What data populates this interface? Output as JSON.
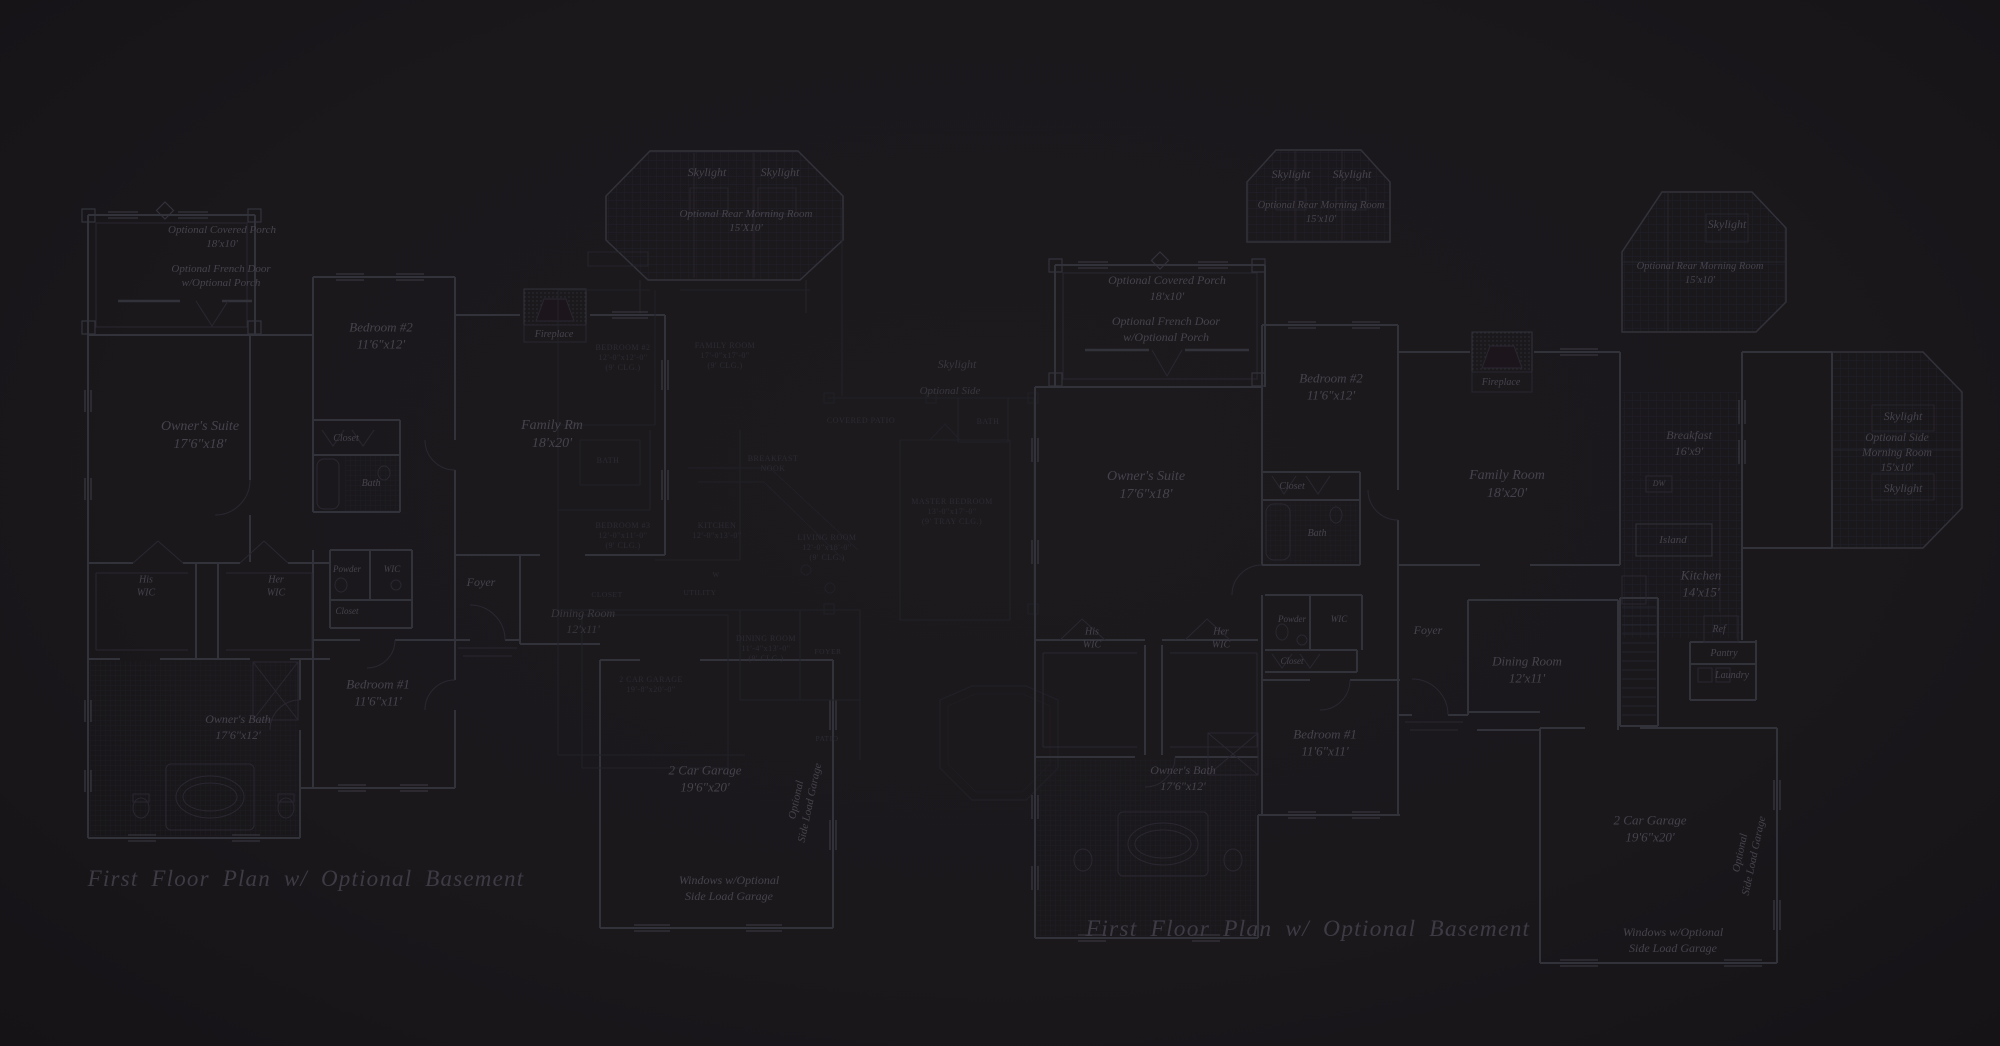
{
  "palette": {
    "background": "#1a181b",
    "wall_main": "#33313a",
    "wall_detail": "#2a2830",
    "wall_faint": "#232129",
    "grid_line": "#242230",
    "tile_line": "#221f28",
    "fireplace_dot": "#2f2d35",
    "window_tick": "#3c3a44",
    "text_main": "#46434d",
    "text_caps": "#2d2b33",
    "text_title": "#3e3b45"
  },
  "plan_left": {
    "title": "First Floor Plan  w/ Optional Basement",
    "labels": [
      {
        "name": "label-covered-porch",
        "lines": [
          "Optional Covered Porch",
          "18'x10'"
        ],
        "x": 222,
        "y": 240,
        "size": 11,
        "tier": "main"
      },
      {
        "name": "label-french-door",
        "lines": [
          "Optional French Door",
          "w/Optional Porch"
        ],
        "x": 221,
        "y": 279,
        "size": 11,
        "tier": "main"
      },
      {
        "name": "label-skylight-1",
        "lines": [
          "Skylight"
        ],
        "x": 707,
        "y": 176,
        "size": 12,
        "tier": "main"
      },
      {
        "name": "label-skylight-2",
        "lines": [
          "Skylight"
        ],
        "x": 780,
        "y": 176,
        "size": 12,
        "tier": "main"
      },
      {
        "name": "label-rear-morning-room",
        "lines": [
          "Optional Rear Morning Room",
          "15'X10'"
        ],
        "x": 746,
        "y": 224,
        "size": 11,
        "tier": "main"
      },
      {
        "name": "label-bedroom-2",
        "lines": [
          "Bedroom #2",
          "11'6\"x12'"
        ],
        "x": 381,
        "y": 340,
        "size": 13,
        "tier": "main"
      },
      {
        "name": "label-fireplace",
        "lines": [
          "Fireplace"
        ],
        "x": 554,
        "y": 337,
        "size": 10,
        "tier": "main"
      },
      {
        "name": "label-family-rm",
        "lines": [
          "Family Rm",
          "18'x20'"
        ],
        "x": 552,
        "y": 438,
        "size": 14,
        "tier": "main"
      },
      {
        "name": "label-owners-suite",
        "lines": [
          "Owner's Suite",
          "17'6\"x18'"
        ],
        "x": 200,
        "y": 439,
        "size": 14,
        "tier": "main"
      },
      {
        "name": "label-closet-1",
        "lines": [
          "Closet"
        ],
        "x": 346,
        "y": 441,
        "size": 10,
        "tier": "main"
      },
      {
        "name": "label-bath",
        "lines": [
          "Bath"
        ],
        "x": 371,
        "y": 486,
        "size": 10,
        "tier": "main"
      },
      {
        "name": "label-his-wic",
        "lines": [
          "His",
          "WIC"
        ],
        "x": 146,
        "y": 589,
        "size": 10,
        "tier": "main"
      },
      {
        "name": "label-her-wic",
        "lines": [
          "Her",
          "WIC"
        ],
        "x": 276,
        "y": 589,
        "size": 10,
        "tier": "main"
      },
      {
        "name": "label-powder",
        "lines": [
          "Powder"
        ],
        "x": 347,
        "y": 572,
        "size": 9,
        "tier": "main"
      },
      {
        "name": "label-wic",
        "lines": [
          "WIC"
        ],
        "x": 392,
        "y": 572,
        "size": 9,
        "tier": "main"
      },
      {
        "name": "label-closet-2",
        "lines": [
          "Closet"
        ],
        "x": 347,
        "y": 614,
        "size": 9,
        "tier": "main"
      },
      {
        "name": "label-foyer",
        "lines": [
          "Foyer"
        ],
        "x": 481,
        "y": 586,
        "size": 12,
        "tier": "main"
      },
      {
        "name": "label-dining",
        "lines": [
          "Dining Room",
          "12'x11'"
        ],
        "x": 583,
        "y": 625,
        "size": 12,
        "tier": "main",
        "op": 0.7
      },
      {
        "name": "label-bedroom-1",
        "lines": [
          "Bedroom #1",
          "11'6\"x11'"
        ],
        "x": 378,
        "y": 697,
        "size": 13,
        "tier": "main"
      },
      {
        "name": "label-owners-bath",
        "lines": [
          "Owner's Bath",
          "17'6\"x12'"
        ],
        "x": 238,
        "y": 731,
        "size": 12,
        "tier": "main"
      },
      {
        "name": "label-garage",
        "lines": [
          "2 Car Garage",
          "19'6\"x20'"
        ],
        "x": 705,
        "y": 783,
        "size": 13,
        "tier": "main"
      },
      {
        "name": "label-side-load-garage",
        "lines": [
          "Optional",
          "Side Load Garage"
        ],
        "x": 806,
        "y": 802,
        "size": 11,
        "tier": "main",
        "rot": -78
      },
      {
        "name": "label-windows-side-load",
        "lines": [
          "Windows w/Optional",
          "Side Load Garage"
        ],
        "x": 729,
        "y": 892,
        "size": 12,
        "tier": "main"
      }
    ]
  },
  "plan_middle": {
    "labels": [
      {
        "name": "label-bedroom2-caps",
        "lines": [
          "BEDROOM #2",
          "12'-0\"x12'-0\"",
          "(9' CLG.)"
        ],
        "x": 623,
        "y": 360,
        "size": 8,
        "tier": "caps"
      },
      {
        "name": "label-family-room-caps",
        "lines": [
          "FAMILY ROOM",
          "17'-0\"x17'-0\"",
          "(9' CLG.)"
        ],
        "x": 725,
        "y": 358,
        "size": 8,
        "tier": "caps"
      },
      {
        "name": "label-bath-caps-1",
        "lines": [
          "BATH"
        ],
        "x": 608,
        "y": 463,
        "size": 8,
        "tier": "caps"
      },
      {
        "name": "label-breakfast-nook-caps",
        "lines": [
          "BREAKFAST",
          "NOOK"
        ],
        "x": 773,
        "y": 466,
        "size": 8,
        "tier": "caps"
      },
      {
        "name": "label-bedroom3-caps",
        "lines": [
          "BEDROOM #3",
          "12'-0\"x11'-0\"",
          "(9' CLG.)"
        ],
        "x": 623,
        "y": 538,
        "size": 8,
        "tier": "caps"
      },
      {
        "name": "label-kitchen-caps",
        "lines": [
          "KITCHEN",
          "12'-0\"x13'-0\""
        ],
        "x": 717,
        "y": 533,
        "size": 8,
        "tier": "caps"
      },
      {
        "name": "label-living-room-caps",
        "lines": [
          "LIVING ROOM",
          "12'-0\"x18'-0\"",
          "(9' CLG.)"
        ],
        "x": 827,
        "y": 550,
        "size": 8,
        "tier": "caps"
      },
      {
        "name": "label-closet-caps",
        "lines": [
          "CLOSET"
        ],
        "x": 607,
        "y": 597,
        "size": 7.5,
        "tier": "caps"
      },
      {
        "name": "label-utility-caps",
        "lines": [
          "UTILITY"
        ],
        "x": 700,
        "y": 595,
        "size": 7.5,
        "tier": "caps"
      },
      {
        "name": "label-washer-caps",
        "lines": [
          "W"
        ],
        "x": 716,
        "y": 577,
        "size": 7,
        "tier": "caps"
      },
      {
        "name": "label-garage-caps",
        "lines": [
          "2 CAR GARAGE",
          "19'-8\"x20'-0\""
        ],
        "x": 651,
        "y": 687,
        "size": 8,
        "tier": "caps"
      },
      {
        "name": "label-dining-room-caps",
        "lines": [
          "DINING ROOM",
          "11'-4\"x13'-0\"",
          "(9' CLG.)"
        ],
        "x": 766,
        "y": 651,
        "size": 8,
        "tier": "caps"
      },
      {
        "name": "label-foyer-caps",
        "lines": [
          "FOYER"
        ],
        "x": 828,
        "y": 654,
        "size": 7.5,
        "tier": "caps"
      },
      {
        "name": "label-patio-caps",
        "lines": [
          "PATIO"
        ],
        "x": 827,
        "y": 741,
        "size": 7.5,
        "tier": "caps"
      },
      {
        "name": "label-covered-patio-caps",
        "lines": [
          "COVERED PATIO"
        ],
        "x": 861,
        "y": 423,
        "size": 8,
        "tier": "caps"
      },
      {
        "name": "label-bath-caps-2",
        "lines": [
          "BATH"
        ],
        "x": 988,
        "y": 424,
        "size": 8,
        "tier": "caps"
      },
      {
        "name": "label-master-bedroom-caps",
        "lines": [
          "MASTER BEDROOM",
          "13'-0\"x17'-0\"",
          "(9' TRAY CLG.)"
        ],
        "x": 952,
        "y": 514,
        "size": 8,
        "tier": "caps"
      },
      {
        "name": "label-skylight-mid",
        "lines": [
          "Skylight"
        ],
        "x": 957,
        "y": 368,
        "size": 12,
        "tier": "main",
        "op": 0.7
      },
      {
        "name": "label-optional-side-mid",
        "lines": [
          "Optional Side"
        ],
        "x": 950,
        "y": 394,
        "size": 11,
        "tier": "main",
        "op": 0.7
      }
    ]
  },
  "plan_right": {
    "title": "First Floor Plan  w/ Optional Basement",
    "labels": [
      {
        "name": "label-covered-porch",
        "lines": [
          "Optional Covered Porch",
          "18'x10'"
        ],
        "x": 1167,
        "y": 292,
        "size": 12,
        "tier": "main"
      },
      {
        "name": "label-french-door",
        "lines": [
          "Optional French Door",
          "w/Optional Porch"
        ],
        "x": 1166,
        "y": 333,
        "size": 12,
        "tier": "main"
      },
      {
        "name": "label-skylight-1",
        "lines": [
          "Skylight"
        ],
        "x": 1291,
        "y": 178,
        "size": 12,
        "tier": "main"
      },
      {
        "name": "label-skylight-2",
        "lines": [
          "Skylight"
        ],
        "x": 1352,
        "y": 178,
        "size": 12,
        "tier": "main"
      },
      {
        "name": "label-rear-morning-room-1",
        "lines": [
          "Optional Rear Morning Room",
          "15'x10'"
        ],
        "x": 1321,
        "y": 215,
        "size": 10.5,
        "tier": "main"
      },
      {
        "name": "label-skylight-3",
        "lines": [
          "Skylight"
        ],
        "x": 1727,
        "y": 228,
        "size": 12,
        "tier": "main"
      },
      {
        "name": "label-rear-morning-room-2",
        "lines": [
          "Optional Rear Morning Room",
          "15'x10'"
        ],
        "x": 1700,
        "y": 276,
        "size": 10.5,
        "tier": "main"
      },
      {
        "name": "label-owners-suite",
        "lines": [
          "Owner's Suite",
          "17'6\"x18'"
        ],
        "x": 1146,
        "y": 489,
        "size": 14,
        "tier": "main"
      },
      {
        "name": "label-bedroom-2",
        "lines": [
          "Bedroom #2",
          "11'6\"x12'"
        ],
        "x": 1331,
        "y": 391,
        "size": 13,
        "tier": "main"
      },
      {
        "name": "label-fireplace",
        "lines": [
          "Fireplace"
        ],
        "x": 1501,
        "y": 385,
        "size": 10,
        "tier": "main"
      },
      {
        "name": "label-family-room",
        "lines": [
          "Family Room",
          "18'x20'"
        ],
        "x": 1507,
        "y": 488,
        "size": 14,
        "tier": "main"
      },
      {
        "name": "label-breakfast",
        "lines": [
          "Breakfast",
          "16'x9'"
        ],
        "x": 1689,
        "y": 447,
        "size": 12,
        "tier": "main"
      },
      {
        "name": "label-dw",
        "lines": [
          "DW"
        ],
        "x": 1659,
        "y": 486,
        "size": 8,
        "tier": "main"
      },
      {
        "name": "label-island",
        "lines": [
          "Island"
        ],
        "x": 1673,
        "y": 543,
        "size": 11,
        "tier": "main"
      },
      {
        "name": "label-kitchen",
        "lines": [
          "Kitchen",
          "14'x15'"
        ],
        "x": 1701,
        "y": 588,
        "size": 13,
        "tier": "main"
      },
      {
        "name": "label-ref",
        "lines": [
          "Ref"
        ],
        "x": 1719,
        "y": 632,
        "size": 10,
        "tier": "main"
      },
      {
        "name": "label-pantry",
        "lines": [
          "Pantry"
        ],
        "x": 1724,
        "y": 656,
        "size": 10,
        "tier": "main"
      },
      {
        "name": "label-laundry",
        "lines": [
          "Laundry"
        ],
        "x": 1732,
        "y": 678,
        "size": 10,
        "tier": "main"
      },
      {
        "name": "label-closet-1",
        "lines": [
          "Closet"
        ],
        "x": 1292,
        "y": 489,
        "size": 10,
        "tier": "main"
      },
      {
        "name": "label-bath",
        "lines": [
          "Bath"
        ],
        "x": 1317,
        "y": 536,
        "size": 10,
        "tier": "main"
      },
      {
        "name": "label-his-wic",
        "lines": [
          "His",
          "WIC"
        ],
        "x": 1092,
        "y": 641,
        "size": 10,
        "tier": "main"
      },
      {
        "name": "label-her-wic",
        "lines": [
          "Her",
          "WIC"
        ],
        "x": 1221,
        "y": 641,
        "size": 10,
        "tier": "main"
      },
      {
        "name": "label-powder",
        "lines": [
          "Powder"
        ],
        "x": 1292,
        "y": 622,
        "size": 9,
        "tier": "main"
      },
      {
        "name": "label-wic",
        "lines": [
          "WIC"
        ],
        "x": 1339,
        "y": 622,
        "size": 9,
        "tier": "main"
      },
      {
        "name": "label-closet-2",
        "lines": [
          "Closet"
        ],
        "x": 1292,
        "y": 664,
        "size": 9,
        "tier": "main"
      },
      {
        "name": "label-foyer",
        "lines": [
          "Foyer"
        ],
        "x": 1428,
        "y": 634,
        "size": 12,
        "tier": "main"
      },
      {
        "name": "label-dining-room",
        "lines": [
          "Dining Room",
          "12'x11'"
        ],
        "x": 1527,
        "y": 674,
        "size": 13,
        "tier": "main"
      },
      {
        "name": "label-bedroom-1",
        "lines": [
          "Bedroom #1",
          "11'6\"x11'"
        ],
        "x": 1325,
        "y": 747,
        "size": 13,
        "tier": "main"
      },
      {
        "name": "label-owners-bath",
        "lines": [
          "Owner's Bath",
          "17'6\"x12'"
        ],
        "x": 1183,
        "y": 782,
        "size": 12,
        "tier": "main"
      },
      {
        "name": "label-garage",
        "lines": [
          "2 Car Garage",
          "19'6\"x20'"
        ],
        "x": 1650,
        "y": 833,
        "size": 13,
        "tier": "main"
      },
      {
        "name": "label-side-load-garage",
        "lines": [
          "Optional",
          "Side Load Garage"
        ],
        "x": 1750,
        "y": 855,
        "size": 11,
        "tier": "main",
        "rot": -78
      },
      {
        "name": "label-windows-side-load",
        "lines": [
          "Windows w/Optional",
          "Side Load Garage"
        ],
        "x": 1673,
        "y": 944,
        "size": 12,
        "tier": "main"
      },
      {
        "name": "label-skylight-side-1",
        "lines": [
          "Skylight"
        ],
        "x": 1903,
        "y": 420,
        "size": 12,
        "tier": "main"
      },
      {
        "name": "label-side-morning-room",
        "lines": [
          "Optional Side",
          "Morning Room",
          "15'x10'"
        ],
        "x": 1897,
        "y": 456,
        "size": 11.5,
        "tier": "main"
      },
      {
        "name": "label-skylight-side-2",
        "lines": [
          "Skylight"
        ],
        "x": 1903,
        "y": 492,
        "size": 12,
        "tier": "main"
      }
    ]
  }
}
